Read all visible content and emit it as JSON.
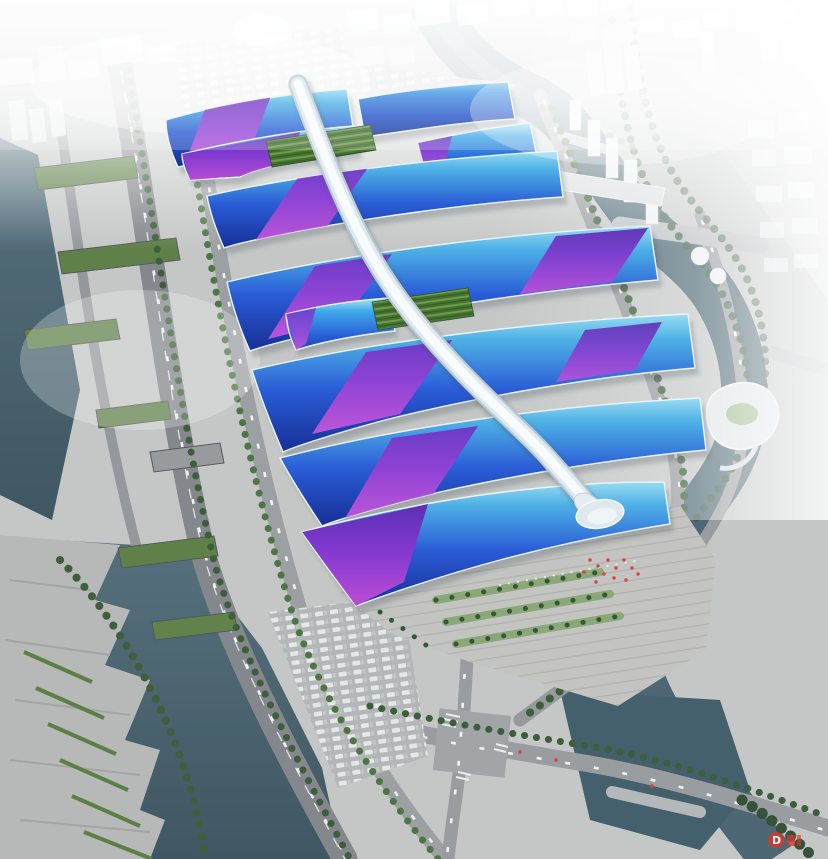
{
  "scene": {
    "type": "aerial-architectural-rendering",
    "subject": "Exhibition and convention center masterplan, bird's-eye rendering",
    "description": "Rows of exhibition halls with cyan-to-navy gradient roofs and purple ribbon graphics flank a white serpentine central concourse that ends at a shell-shaped south entrance plaza; the site is ringed by tree-lined roads, an elevated expressway, winding rivers and a fog-washed white city skyline."
  },
  "palette": {
    "roof-cyan": "#4fb2e6",
    "roof-blue": "#2a5cd6",
    "roof-navy": "#162f95",
    "ribbon-violet": "#6d2fc2",
    "ribbon-magenta": "#cf5adf",
    "concourse-white": "#dde9ef",
    "water-dark": "#3f5763",
    "water-light": "#55707c",
    "road-gray": "#8f9295",
    "plaza-gray": "#c4c5c2",
    "tree-green": "#3c5e3a",
    "garden-green": "#46732f",
    "fog-white": "#ffffff",
    "ground": "#c6c8c7",
    "watermark-red": "#cc3b32"
  },
  "watermark": {
    "logo_letter": "D"
  }
}
